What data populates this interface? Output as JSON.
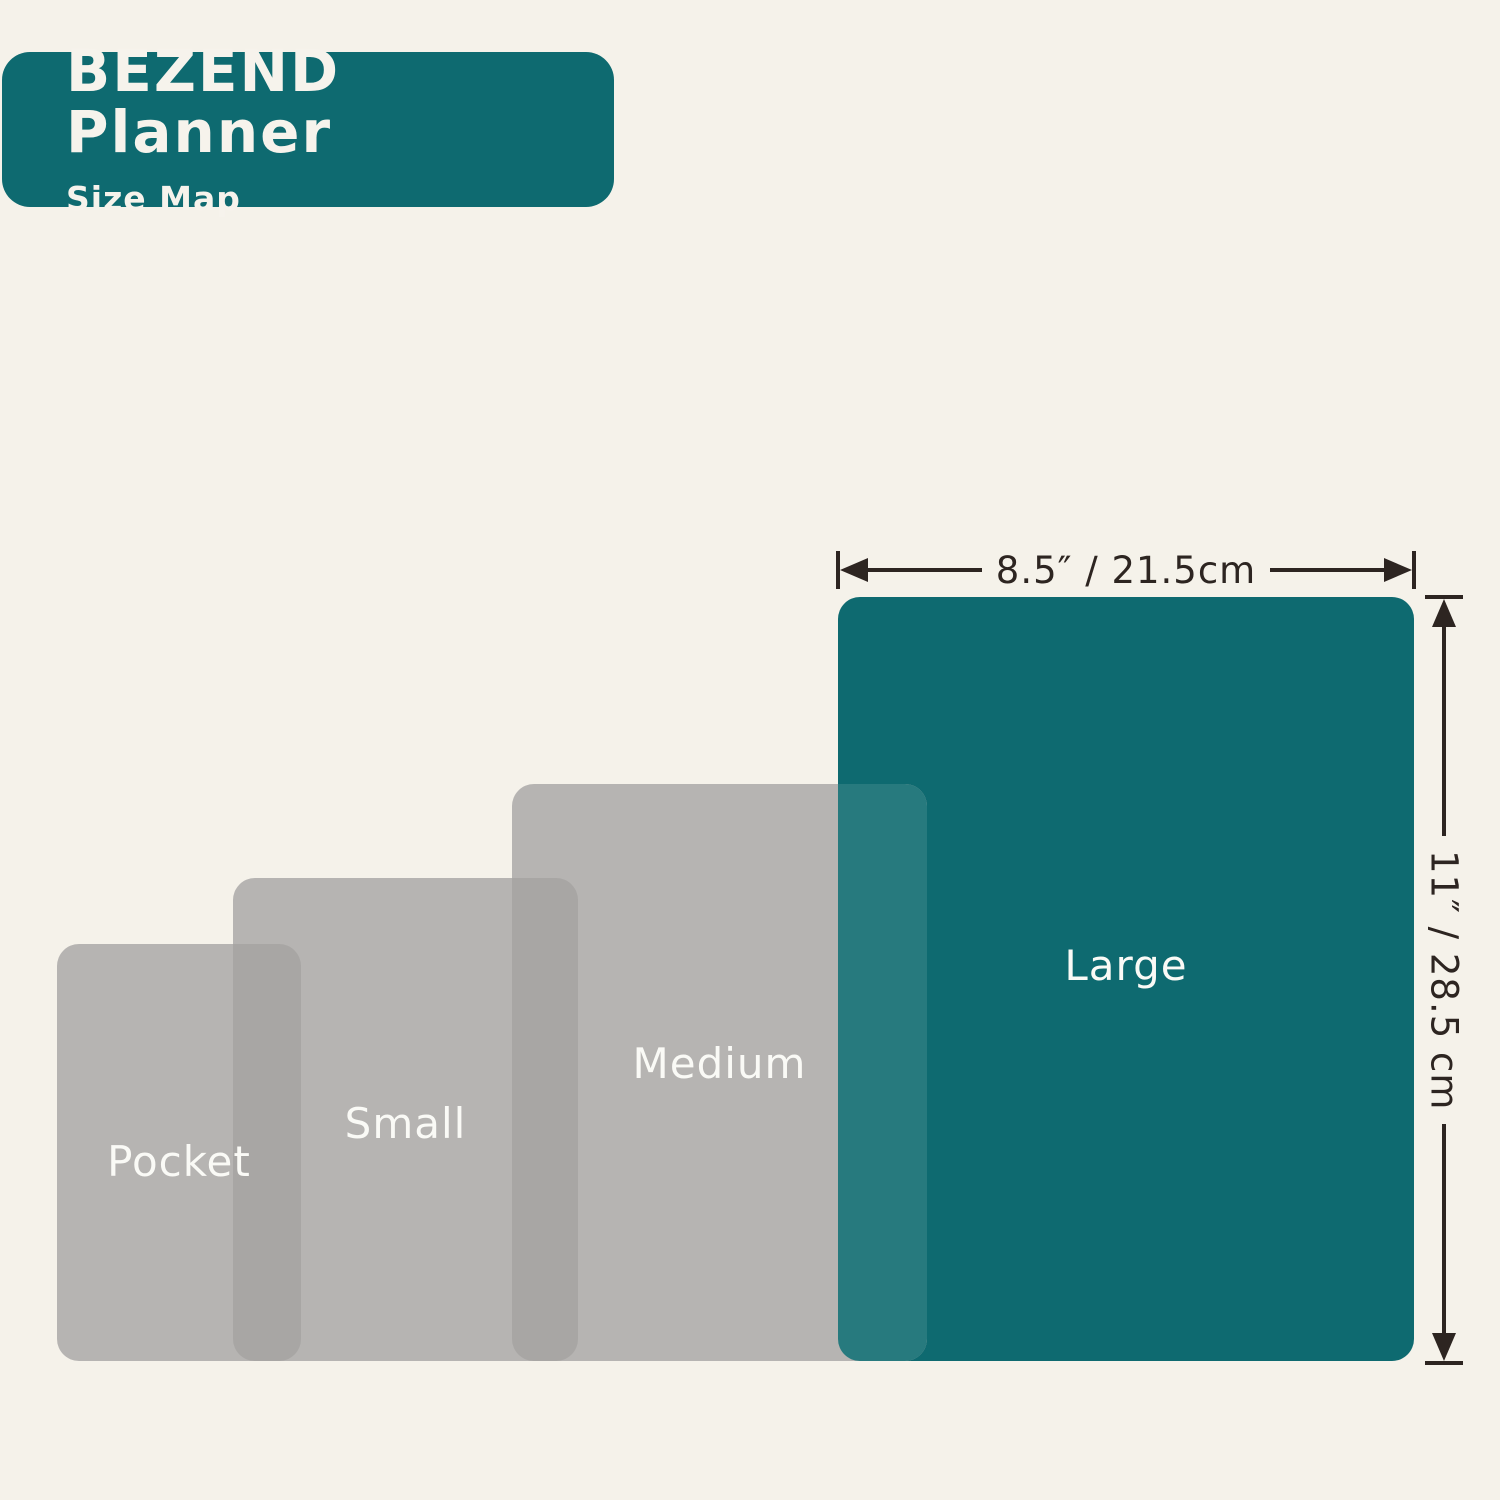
{
  "header": {
    "title": "BEZEND Planner",
    "subtitle": "Size Map"
  },
  "diagram": {
    "sizes": [
      {
        "name": "Pocket"
      },
      {
        "name": "Small"
      },
      {
        "name": "Medium"
      },
      {
        "name": "Large",
        "width_label": "8.5″ / 21.5cm",
        "height_label": "11″ / 28.5 cm"
      }
    ]
  },
  "colors": {
    "background": "#f5f2ea",
    "brand_teal": "#0e6a70",
    "overlap_teal": "#277a7e",
    "size_gray": "#b6b4b2",
    "overlap_gray": "#a8a6a4",
    "dimension_line": "#2d2521",
    "label_text": "#fafaf6",
    "badge_text": "#f6f3ec"
  }
}
